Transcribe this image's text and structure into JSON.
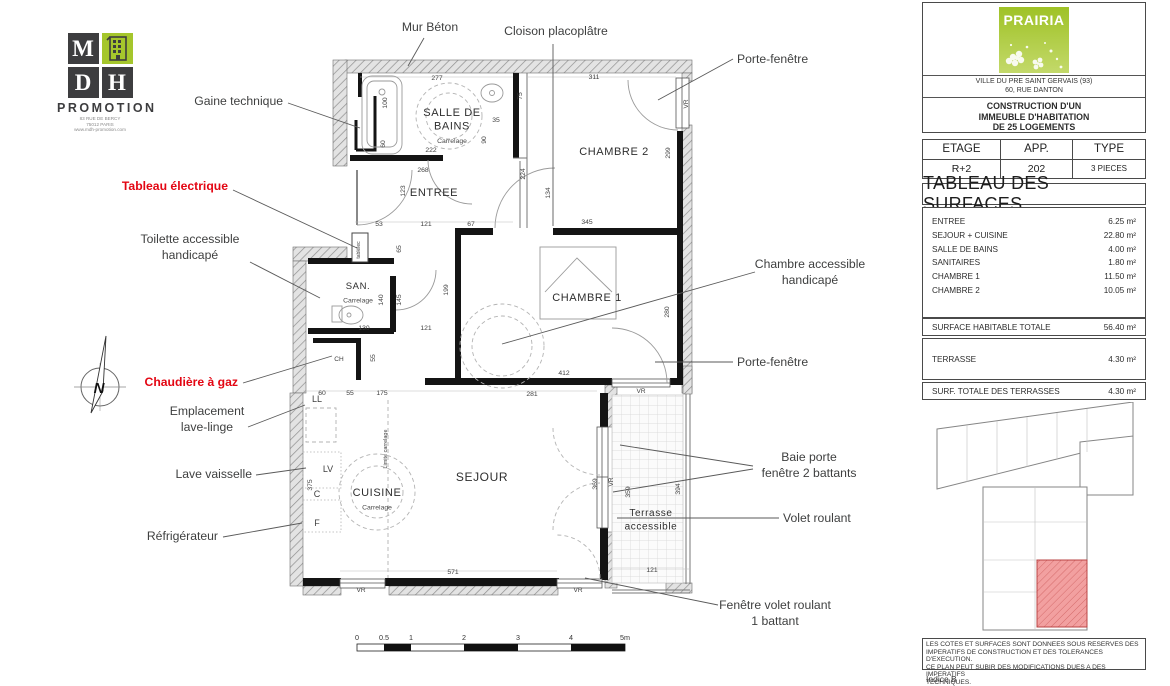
{
  "logo_mdh": {
    "letters": [
      "M",
      "D",
      "H"
    ],
    "promotion": "PROMOTION",
    "address_lines": [
      "83 RUE DE BERCY",
      "75012 PARIS",
      "www.mdh-promotion.com"
    ]
  },
  "plan": {
    "compass_letter": "N",
    "window_label_text": "VR",
    "rooms": [
      {
        "id": "salle-de-bains",
        "name_lines": [
          "SALLE DE",
          "BAINS"
        ],
        "sub": "Carrelage",
        "x": 452,
        "y": 116,
        "size": 11
      },
      {
        "id": "entree",
        "name_lines": [
          "ENTREE"
        ],
        "x": 434,
        "y": 196,
        "size": 11
      },
      {
        "id": "chambre-2",
        "name_lines": [
          "CHAMBRE 2"
        ],
        "x": 614,
        "y": 155,
        "size": 11
      },
      {
        "id": "chambre-1",
        "name_lines": [
          "CHAMBRE 1"
        ],
        "x": 587,
        "y": 301,
        "size": 11
      },
      {
        "id": "san",
        "name_lines": [
          "SAN."
        ],
        "sub": "Carrelage",
        "x": 358,
        "y": 289,
        "size": 9.5
      },
      {
        "id": "cuisine",
        "name_lines": [
          "CUISINE"
        ],
        "sub": "Carrelage",
        "x": 377,
        "y": 496,
        "size": 11
      },
      {
        "id": "sejour",
        "name_lines": [
          "SEJOUR"
        ],
        "x": 482,
        "y": 481,
        "size": 12
      },
      {
        "id": "terrasse",
        "name_lines": [
          "Terrasse",
          "accessible"
        ],
        "x": 651,
        "y": 516,
        "size": 10
      }
    ],
    "dimensions": [
      {
        "t": "277",
        "x": 437,
        "y": 80
      },
      {
        "t": "311",
        "x": 594,
        "y": 79
      },
      {
        "t": "100",
        "x": 387,
        "y": 103,
        "v": 1
      },
      {
        "t": "75",
        "x": 522,
        "y": 96,
        "v": 1
      },
      {
        "t": "35",
        "x": 496,
        "y": 122
      },
      {
        "t": "90",
        "x": 486,
        "y": 140,
        "v": 1
      },
      {
        "t": "60",
        "x": 385,
        "y": 144,
        "v": 1
      },
      {
        "t": "222",
        "x": 431,
        "y": 152
      },
      {
        "t": "299",
        "x": 670,
        "y": 153,
        "v": 1
      },
      {
        "t": "268",
        "x": 423,
        "y": 172
      },
      {
        "t": "123",
        "x": 405,
        "y": 191,
        "v": 1
      },
      {
        "t": "134",
        "x": 550,
        "y": 193,
        "v": 1
      },
      {
        "t": "224",
        "x": 525,
        "y": 174,
        "v": 1
      },
      {
        "t": "345",
        "x": 587,
        "y": 224
      },
      {
        "t": "53",
        "x": 379,
        "y": 226
      },
      {
        "t": "121",
        "x": 426,
        "y": 226
      },
      {
        "t": "67",
        "x": 471,
        "y": 226
      },
      {
        "t": "65",
        "x": 401,
        "y": 249,
        "v": 1
      },
      {
        "t": "140",
        "x": 383,
        "y": 300,
        "v": 1
      },
      {
        "t": "145",
        "x": 401,
        "y": 300,
        "v": 1
      },
      {
        "t": "199",
        "x": 448,
        "y": 290,
        "v": 1
      },
      {
        "t": "280",
        "x": 669,
        "y": 312,
        "v": 1
      },
      {
        "t": "130",
        "x": 364,
        "y": 330
      },
      {
        "t": "121",
        "x": 426,
        "y": 330
      },
      {
        "t": "55",
        "x": 375,
        "y": 358,
        "v": 1
      },
      {
        "t": "412",
        "x": 564,
        "y": 375
      },
      {
        "t": "60",
        "x": 322,
        "y": 395
      },
      {
        "t": "55",
        "x": 350,
        "y": 395
      },
      {
        "t": "175",
        "x": 382,
        "y": 395
      },
      {
        "t": "281",
        "x": 532,
        "y": 396
      },
      {
        "t": "369",
        "x": 597,
        "y": 484,
        "v": 1
      },
      {
        "t": "359",
        "x": 630,
        "y": 492,
        "v": 1
      },
      {
        "t": "394",
        "x": 680,
        "y": 489,
        "v": 1
      },
      {
        "t": "375",
        "x": 312,
        "y": 485,
        "v": 1
      },
      {
        "t": "571",
        "x": 453,
        "y": 574
      },
      {
        "t": "121",
        "x": 652,
        "y": 572
      }
    ],
    "window_labels": [
      {
        "x": 688,
        "y": 104,
        "v": 1
      },
      {
        "x": 641,
        "y": 393
      },
      {
        "x": 613,
        "y": 482,
        "v": 1
      },
      {
        "x": 361,
        "y": 592
      },
      {
        "x": 578,
        "y": 592
      }
    ],
    "misc_labels": [
      {
        "t": "tablélec",
        "x": 360,
        "y": 250,
        "v": 1,
        "size": 5
      },
      {
        "t": "CH",
        "x": 339,
        "y": 361,
        "size": 6.5
      },
      {
        "t": "Limite carrelage",
        "x": 387,
        "y": 449,
        "v": 1,
        "size": 5.5
      },
      {
        "t": "LL",
        "x": 317,
        "y": 402,
        "size": 9
      },
      {
        "t": "LV",
        "x": 328,
        "y": 472,
        "size": 9
      },
      {
        "t": "C",
        "x": 317,
        "y": 497,
        "size": 9
      },
      {
        "t": "F",
        "x": 317,
        "y": 526,
        "size": 9
      }
    ],
    "annotations": [
      {
        "id": "mur-beton",
        "lines": [
          "Mur Béton"
        ],
        "x": 430,
        "y": 31,
        "anchor": "middle",
        "leaders": [
          [
            424,
            38,
            408,
            66
          ]
        ]
      },
      {
        "id": "cloison-placoplatre",
        "lines": [
          "Cloison placoplâtre"
        ],
        "x": 556,
        "y": 35,
        "anchor": "middle",
        "leaders": [
          [
            553,
            44,
            553,
            226
          ]
        ]
      },
      {
        "id": "porte-fenetre-haut",
        "lines": [
          "Porte-fenêtre"
        ],
        "x": 737,
        "y": 63,
        "anchor": "start",
        "leaders": [
          [
            733,
            59,
            658,
            100
          ]
        ]
      },
      {
        "id": "gaine-technique",
        "lines": [
          "Gaine technique"
        ],
        "x": 283,
        "y": 105,
        "anchor": "end",
        "leaders": [
          [
            288,
            103,
            360,
            128
          ]
        ]
      },
      {
        "id": "tableau-electrique",
        "lines": [
          "Tableau électrique"
        ],
        "x": 228,
        "y": 190,
        "anchor": "end",
        "color": "red",
        "leaders": [
          [
            233,
            190,
            357,
            248
          ]
        ]
      },
      {
        "id": "toilette-accessible",
        "lines": [
          "Toilette accessible",
          "handicapé"
        ],
        "x": 190,
        "y": 243,
        "anchor": "middle",
        "leaders": [
          [
            250,
            262,
            320,
            298
          ]
        ]
      },
      {
        "id": "chaudiere-gaz",
        "lines": [
          "Chaudière à gaz"
        ],
        "x": 238,
        "y": 386,
        "anchor": "end",
        "color": "red",
        "leaders": [
          [
            243,
            383,
            332,
            356
          ]
        ]
      },
      {
        "id": "emplacement-lave-linge",
        "lines": [
          "Emplacement",
          "lave-linge"
        ],
        "x": 207,
        "y": 415,
        "anchor": "middle",
        "leaders": [
          [
            248,
            427,
            305,
            405
          ]
        ]
      },
      {
        "id": "lave-vaisselle",
        "lines": [
          "Lave vaisselle"
        ],
        "x": 252,
        "y": 478,
        "anchor": "end",
        "leaders": [
          [
            256,
            475,
            306,
            468
          ]
        ]
      },
      {
        "id": "refrigerateur",
        "lines": [
          "Réfrigérateur"
        ],
        "x": 218,
        "y": 540,
        "anchor": "end",
        "leaders": [
          [
            223,
            537,
            302,
            523
          ]
        ]
      },
      {
        "id": "chambre-accessible",
        "lines": [
          "Chambre accessible",
          "handicapé"
        ],
        "x": 810,
        "y": 268,
        "anchor": "middle",
        "leaders": [
          [
            755,
            272,
            502,
            344
          ]
        ]
      },
      {
        "id": "porte-fenetre-droit",
        "lines": [
          "Porte-fenêtre"
        ],
        "x": 737,
        "y": 366,
        "anchor": "start",
        "leaders": [
          [
            733,
            362,
            655,
            362
          ]
        ]
      },
      {
        "id": "baie-porte-fenetre",
        "lines": [
          "Baie porte",
          "fenêtre 2 battants"
        ],
        "x": 809,
        "y": 461,
        "anchor": "middle",
        "leaders": [
          [
            753,
            466,
            620,
            445
          ],
          [
            753,
            469,
            613,
            492
          ]
        ]
      },
      {
        "id": "volet-roulant",
        "lines": [
          "Volet roulant"
        ],
        "x": 783,
        "y": 522,
        "anchor": "start",
        "leaders": [
          [
            779,
            518,
            617,
            518
          ]
        ]
      },
      {
        "id": "fenetre-volet-roulant",
        "lines": [
          "Fenêtre volet roulant",
          "1 battant"
        ],
        "x": 775,
        "y": 609,
        "anchor": "middle",
        "leaders": [
          [
            718,
            605,
            585,
            578
          ]
        ]
      }
    ],
    "scale_bar": {
      "labels": [
        {
          "t": "0",
          "x": 357
        },
        {
          "t": "0.5",
          "x": 384
        },
        {
          "t": "1",
          "x": 411
        },
        {
          "t": "2",
          "x": 464
        },
        {
          "t": "3",
          "x": 518
        },
        {
          "t": "4",
          "x": 571
        },
        {
          "t": "5m",
          "x": 625
        }
      ]
    }
  },
  "title_block": {
    "project": {
      "brand": "PRAIRIA",
      "city": "VILLE DU PRE SAINT GERVAIS (93)",
      "street": "60, RUE DANTON",
      "description_lines": [
        "CONSTRUCTION D'UN",
        "IMMEUBLE D'HABITATION",
        "DE 25 LOGEMENTS"
      ]
    },
    "unit_table": {
      "headers": [
        "ETAGE",
        "APP.",
        "TYPE"
      ],
      "values": [
        "R+2",
        "202",
        "3 PIECES"
      ]
    },
    "surfaces": {
      "title": "TABLEAU DES SURFACES",
      "rows": [
        {
          "label": "ENTREE",
          "value": "6.25 m²"
        },
        {
          "label": "SEJOUR + CUISINE",
          "value": "22.80 m²"
        },
        {
          "label": "SALLE DE BAINS",
          "value": "4.00 m²"
        },
        {
          "label": "SANITAIRES",
          "value": "1.80 m²"
        },
        {
          "label": "CHAMBRE 1",
          "value": "11.50 m²"
        },
        {
          "label": "CHAMBRE 2",
          "value": "10.05 m²"
        }
      ],
      "total_row": {
        "label": "SURFACE HABITABLE TOTALE",
        "value": "56.40 m²"
      },
      "terrace_row": {
        "label": "TERRASSE",
        "value": "4.30 m²"
      },
      "terrace_total_row": {
        "label": "SURF. TOTALE DES TERRASSES",
        "value": "4.30 m²"
      }
    },
    "notes_lines": [
      "LES COTES ET SURFACES SONT DONNEES SOUS RESERVES DES",
      "IMPERATIFS DE CONSTRUCTION ET DES TOLERANCES D'EXECUTION.",
      "CE PLAN PEUT SUBIR DES MODIFICATIONS DUES A DES IMPERATIFS",
      "TECHNIQUES."
    ],
    "revision": "Indice B"
  },
  "colors": {
    "red_label": "#e30613",
    "dark_label": "#3f4040",
    "wall_black": "#141414",
    "prairia_green": "#9fc226",
    "keyplan_highlight": "#f0a0a0"
  }
}
